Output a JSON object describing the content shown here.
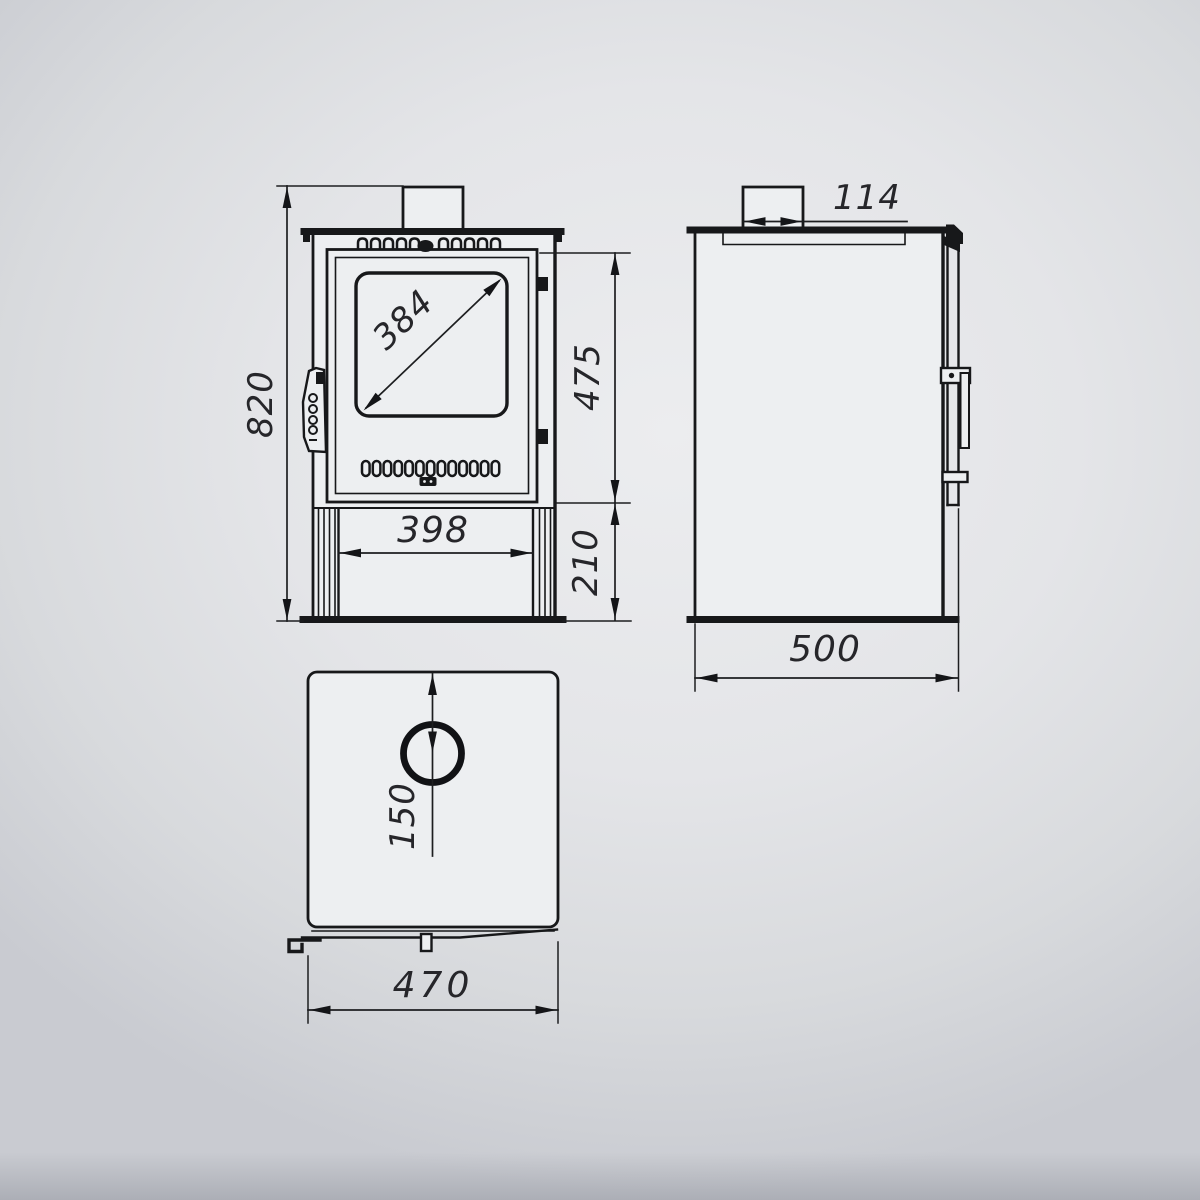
{
  "drawing": {
    "front_view": {
      "overall_height": "820",
      "glass_diagonal": "384",
      "door_height": "475",
      "base_opening_width": "398",
      "base_height": "210"
    },
    "side_view": {
      "flue_collar_width": "114",
      "depth": "500"
    },
    "top_view": {
      "flue_centre_offset": "150",
      "width": "470"
    },
    "colors": {
      "background": "#e4e5e8",
      "line": "#17181a",
      "panel_face": "#edeff1",
      "dimension_text": "#26262a"
    }
  }
}
